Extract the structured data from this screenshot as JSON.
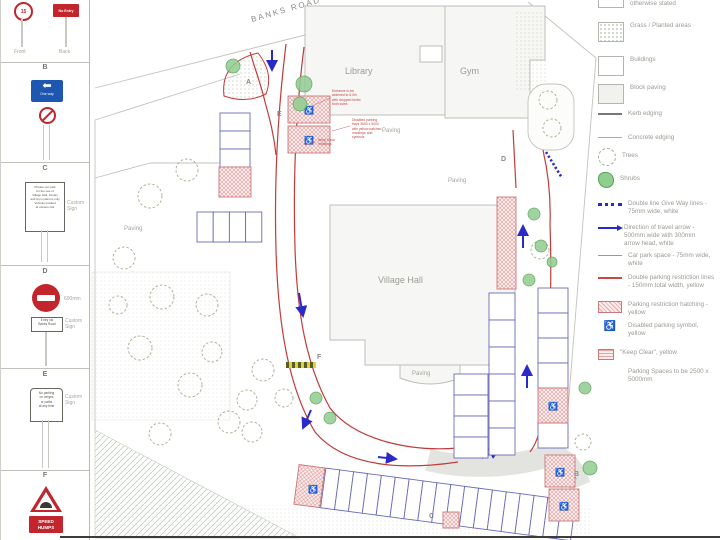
{
  "sidebar": {
    "sections": {
      "a": {
        "front_sign": "15",
        "back_sign": "No Entry",
        "front_label": "Front",
        "back_label": "Back"
      },
      "b": {
        "heading": "B",
        "arrow_glyph": "⬅",
        "caption": "One way"
      },
      "c": {
        "heading": "C",
        "sign_text": "Private car park\nfor the use of\nVillage Hall, Library\nand Gym patrons only\nVehicles parked\nat owners risk",
        "note": "Custom\nSign"
      },
      "d": {
        "heading": "D",
        "dimension": "600mm",
        "plate_text": "Entry via\nBanks Road",
        "note": "Custom\nSign"
      },
      "e": {
        "heading": "E",
        "sign_text": "No parking\non verges\nor paths\nat any time",
        "note": "Custom\nSign"
      },
      "f": {
        "heading": "F",
        "plate_text": "SPEED\nHUMPS"
      }
    }
  },
  "plan": {
    "streets": {
      "top": "BANKS ROAD",
      "right": "CHURCHWAY"
    },
    "buildings": {
      "library": "Library",
      "gym": "Gym",
      "village_hall": "Village Hall"
    },
    "paving": "Paving",
    "markers": {
      "a": "A",
      "b": "B",
      "c": "C",
      "d": "D",
      "e": "E",
      "f": "F"
    },
    "annotations": {
      "a1": "Entrance to be\nwidened to 6.0m\nwith dropped kerbs\nboth sides",
      "a2": "Disabled parking\nbays 3600 x 5000\nwith yellow hatched\nmarkings and\nsymbols",
      "a3": "Keep Clear\nmarkings"
    }
  },
  "icons": {
    "wheelchair": "♿"
  },
  "legend": {
    "items": [
      {
        "label": "otherwise stated"
      },
      {
        "label": "Grass / Planted areas"
      },
      {
        "label": "Buildings"
      },
      {
        "label": "Block paving"
      },
      {
        "label": "Kerb edging"
      },
      {
        "label": "Concrete edging"
      },
      {
        "label": "Trees"
      },
      {
        "label": "Shrubs"
      },
      {
        "label": "Double line Give Way lines - 75mm wide, white"
      },
      {
        "label": "Direction of travel arrow - 500mm wide with 300mm arrow head, white"
      },
      {
        "label": "Car park space - 75mm wide, white"
      },
      {
        "label": "Double parking restriction lines - 150mm total width, yellow"
      },
      {
        "label": "Parking restriction hatching - yellow"
      },
      {
        "label": "Disabled parking symbol, yellow"
      },
      {
        "label": "\"Keep Clear\", yellow"
      },
      {
        "label": "Parking Spaces to be 2500 x 5000mm"
      }
    ]
  }
}
